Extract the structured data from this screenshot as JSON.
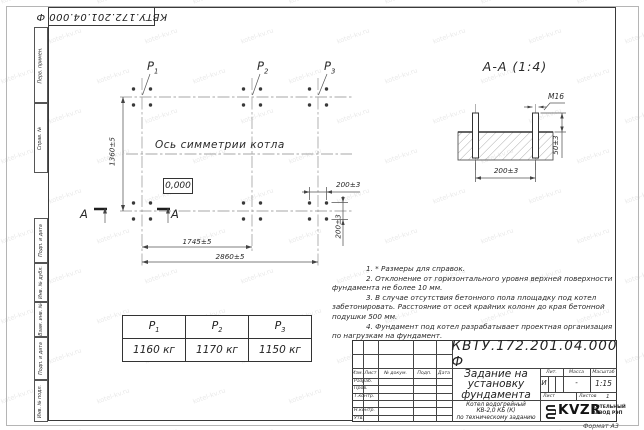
{
  "sheet": {
    "designation": "КВТУ.172.201.04.000  Ф",
    "format_note": "Формат А3",
    "watermark": "kotel-kv.ru"
  },
  "margin_fields": [
    "Перв. примен.",
    "Справ. №",
    "Подп. и дата",
    "Инв. № дубл.",
    "Взам. инв. №",
    "Подп. и дата",
    "Инв. № подл."
  ],
  "plan": {
    "axis_label": "Ось симметрии котла",
    "elevation": "0,000",
    "section_letter": "А",
    "load_points": [
      {
        "name": "P",
        "sub": "1"
      },
      {
        "name": "P",
        "sub": "2"
      },
      {
        "name": "P",
        "sub": "3"
      }
    ],
    "dims": {
      "height": "1360±5",
      "width_left": "1745±5",
      "width_total": "2860±5",
      "bolt_spacing_x": "200±3",
      "bolt_spacing_y": "200±3"
    }
  },
  "section": {
    "title": "А-А (1:4)",
    "thread": "М16",
    "protrusion": "50±3",
    "spacing": "200±3"
  },
  "notes": [
    {
      "indent": true,
      "text": "1. * Размеры для справок."
    },
    {
      "indent": true,
      "text": "2. Отклонение от горизонтального уровня верхней поверхности"
    },
    {
      "indent": false,
      "text": "фундамента не более 10 мм."
    },
    {
      "indent": true,
      "text": "3. В случае отсутствия бетонного пола площадку под котел"
    },
    {
      "indent": false,
      "text": "забетонировать. Расстояние от осей крайних колонн до края бетонной"
    },
    {
      "indent": false,
      "text": "подушки 500 мм."
    },
    {
      "indent": true,
      "text": "4. Фундамент под котел разрабатывает проектная организация"
    },
    {
      "indent": false,
      "text": "по нагрузкам на фундамент."
    }
  ],
  "load_table": {
    "columns": [
      {
        "name": "P",
        "sub": "1",
        "value": "1160 кг"
      },
      {
        "name": "P",
        "sub": "2",
        "value": "1170 кг"
      },
      {
        "name": "P",
        "sub": "3",
        "value": "1150 кг"
      }
    ]
  },
  "title_block": {
    "doc_number": "КВТУ.172.201.04.000  Ф",
    "title_lines": [
      "Задание на",
      "установку",
      "фундамента"
    ],
    "product_lines": [
      "Котел водогрейный",
      "КВ-2,0 КБ (К)",
      "по техническому заданию"
    ],
    "header_cols": [
      "Изм.",
      "Лист",
      "№ докум.",
      "Подп.",
      "Дата"
    ],
    "staff_rows": [
      "Разраб.",
      "Пров.",
      "Т.контр.",
      "",
      "Н.контр.",
      "Утв."
    ],
    "lit_label": "Лит.",
    "lit_value": "И",
    "mass_label": "Масса",
    "mass_value": "-",
    "scale_label": "Масштаб",
    "scale_value": "1:15",
    "sheet_label": "Лист",
    "sheets_label": "Листов",
    "sheets_value": "1",
    "logo_text": "KVZR",
    "company_lines": [
      "КОТЕЛЬНЫЙ",
      "ЗАВОД РЭП"
    ]
  }
}
